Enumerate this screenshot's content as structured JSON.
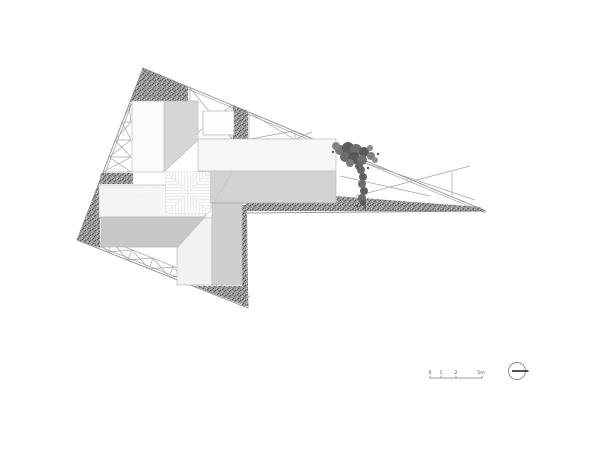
{
  "drawing": {
    "kind": "architectural-roof-site-plan",
    "background": "#ffffff"
  },
  "palette": {
    "boundary_line": "#8f8f8f",
    "truss_line": "#a3a3a3",
    "gravel_base": "#979797",
    "gravel_dot_dark": "#4e4e4e",
    "gravel_dot_light": "#c9c9c9",
    "roof_white": "#f7f7f7",
    "roof_light_gray": "#d4d4d4",
    "roof_mid_gray": "#c7c7c7",
    "vegetation": "#6b6b6b",
    "skylight_hatch": "#e2e2e2",
    "north_needle": "#3a3a3a"
  },
  "scale_bar": {
    "labels": [
      "0",
      "1",
      "2",
      "5m"
    ],
    "unit": "m"
  },
  "north_indicator": {
    "symbol": "circle-with-needle"
  }
}
